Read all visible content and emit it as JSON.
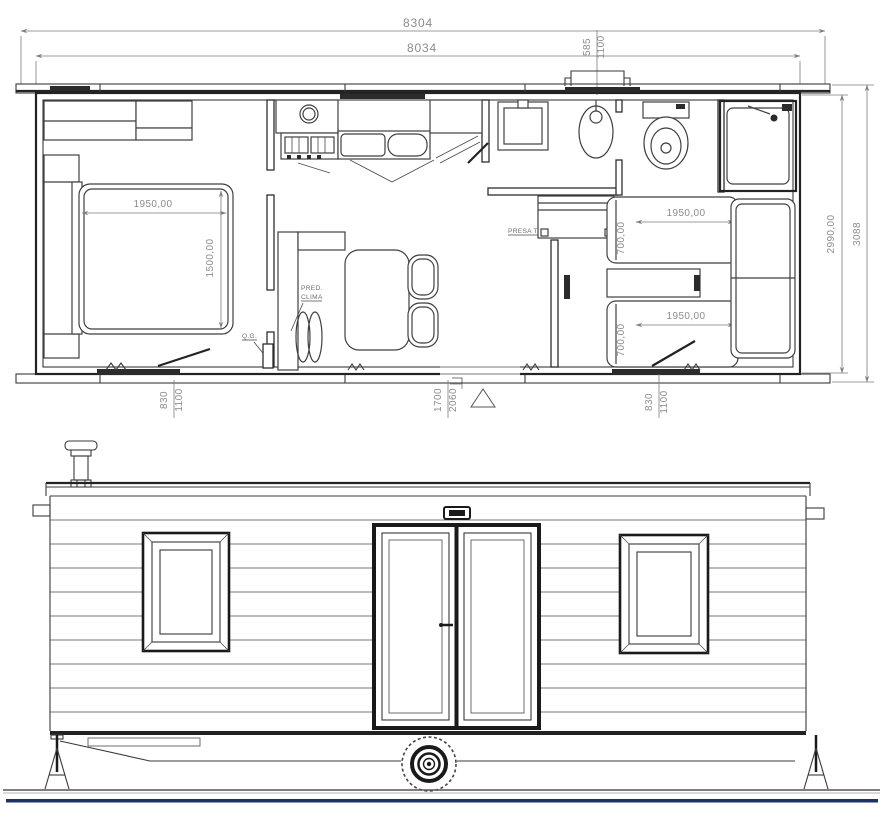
{
  "floor_plan": {
    "dimensions": {
      "roof_length": "8304",
      "body_length": "8034",
      "vent_width": "585",
      "vent_offset": "1100",
      "body_width": "2990,00",
      "overall_width": "3088",
      "double_bed_length": "1950,00",
      "double_bed_width": "1500,00",
      "single_bed_top_length": "1950,00",
      "single_bed_top_width": "700,00",
      "single_bed_bottom_length": "1950,00",
      "single_bed_bottom_width": "700,00",
      "window_left_width": "830",
      "window_left_height": "1100",
      "entry_door_width": "1700",
      "entry_door_height": "2060",
      "window_right_width": "830",
      "window_right_height": "1100"
    },
    "annotations": {
      "climate_line1": "PRED.",
      "climate_line2": "CLIMA",
      "electrical_panel": "Q.G.",
      "tv_socket": "PRESA TV"
    }
  },
  "colors": {
    "line": "#3a3a3a",
    "dim_text": "#8c8c8c",
    "baseline": "#1f3265"
  }
}
